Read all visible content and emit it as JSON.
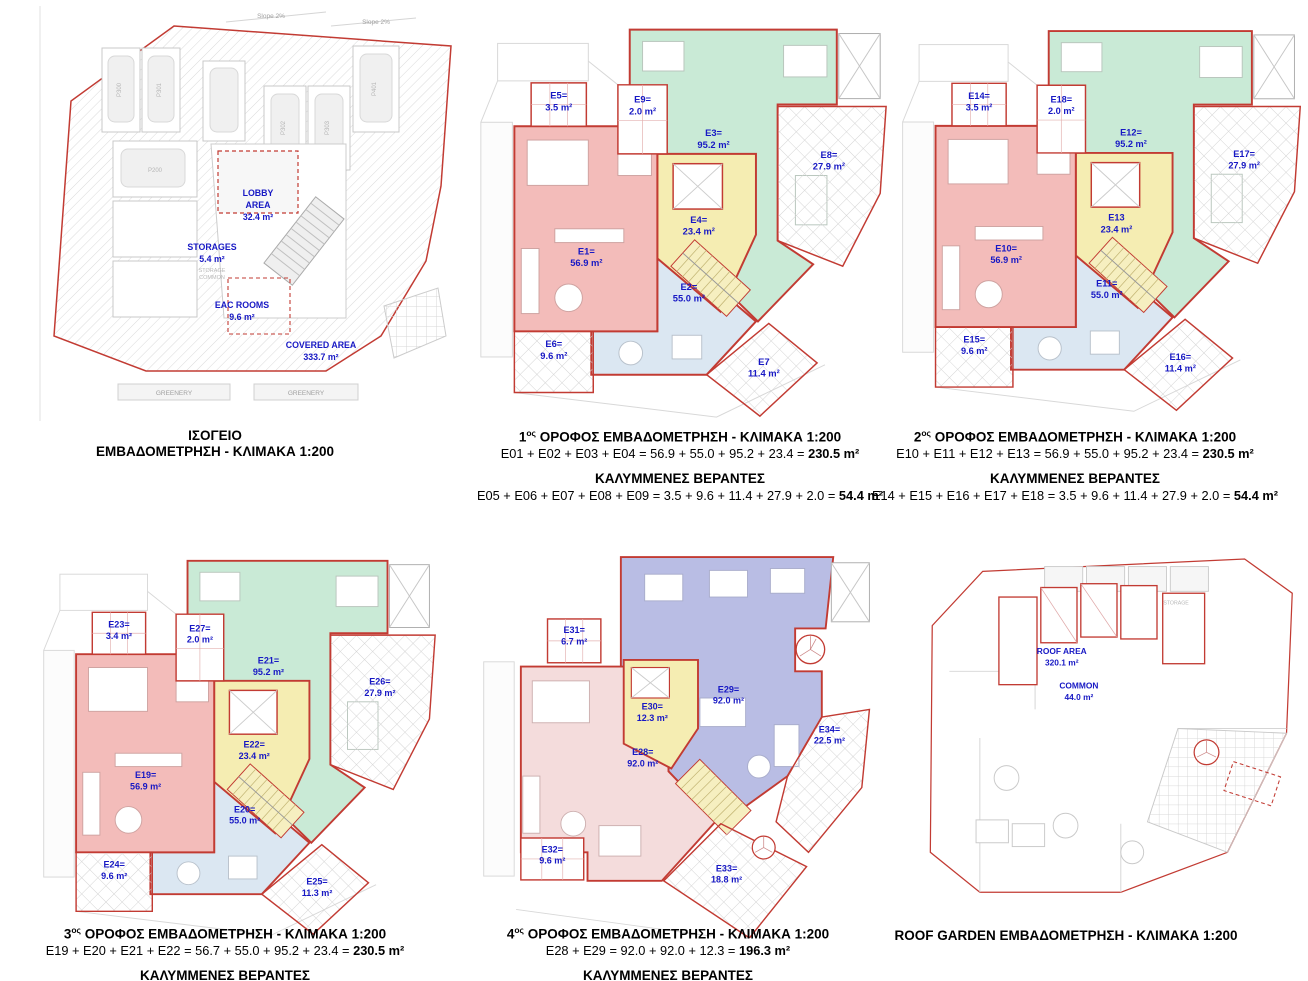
{
  "g": {
    "cap1": "ΙΣΟΓΕΙΟ",
    "cap2": "ΕΜΒΑΔΟΜΕΤΡΗΣΗ - ΚΛΙΜΑΚΑ 1:200",
    "slope_a": "Slope 2%",
    "slope_b": "Slope 2%",
    "greenery_a": "GREENERY",
    "greenery_b": "GREENERY",
    "storage_common_1": "STORAGE",
    "storage_common_2": "COMMON",
    "parking": {
      "a": "P300",
      "b": "P301",
      "c": "P302",
      "d": "P303",
      "e": "P401",
      "f": "P200"
    },
    "areas": {
      "lobby1": "LOBBY",
      "lobby2": "AREA",
      "lobby3": "32.4 m²",
      "stor1": "STORAGES",
      "stor2": "5.4 m²",
      "eac1": "EAC ROOMS",
      "eac2": "9.6 m²",
      "cov1": "COVERED AREA",
      "cov2": "333.7 m²"
    }
  },
  "f1": {
    "num": "1",
    "sup": "ος",
    "rest": " ΟΡΟΦΟΣ ΕΜΒΑΔΟΜΕΤΡΗΣΗ - ΚΛΙΜΑΚΑ 1:200",
    "sum_pre": "E01 + E02 + E03 + E04 = 56.9 + 55.0 + 95.2 + 23.4 =",
    "sum_total": "230.5 m²",
    "ver_title": "ΚΑΛΥΜΜΕΝΕΣ ΒΕΡΑΝΤΕΣ",
    "ver_pre": "E05 + E06 + E07 + E08 + E09 = 3.5 + 9.6 + 11.4 + 27.9 + 2.0 =",
    "ver_total": "54.4 m²",
    "units": {
      "e1": {
        "id": "E1=",
        "area": "56.9 m²"
      },
      "e2": {
        "id": "E2=",
        "area": "55.0 m²"
      },
      "e3": {
        "id": "E3=",
        "area": "95.2 m²"
      },
      "e4": {
        "id": "E4=",
        "area": "23.4 m²"
      },
      "e5": {
        "id": "E5=",
        "area": "3.5 m²"
      },
      "e6": {
        "id": "E6=",
        "area": "9.6 m²"
      },
      "e7": {
        "id": "E7",
        "area": "11.4 m²"
      },
      "e8": {
        "id": "E8=",
        "area": "27.9 m²"
      },
      "e9": {
        "id": "E9=",
        "area": "2.0 m²"
      }
    }
  },
  "f2": {
    "num": "2",
    "sup": "ος",
    "rest": " ΟΡΟΦΟΣ ΕΜΒΑΔΟΜΕΤΡΗΣΗ - ΚΛΙΜΑΚΑ 1:200",
    "sum_pre": "E10 + E11 + E12 + E13 = 56.9 + 55.0 + 95.2 + 23.4 =",
    "sum_total": "230.5 m²",
    "ver_title": "ΚΑΛΥΜΜΕΝΕΣ ΒΕΡΑΝΤΕΣ",
    "ver_pre": "E14 + E15 + E16 + E17 + E18 = 3.5 + 9.6 + 11.4 + 27.9 + 2.0 =",
    "ver_total": "54.4 m²",
    "units": {
      "e10": {
        "id": "E10=",
        "area": "56.9 m²"
      },
      "e11": {
        "id": "E11=",
        "area": "55.0 m²"
      },
      "e12": {
        "id": "E12=",
        "area": "95.2 m²"
      },
      "e13": {
        "id": "E13",
        "area": "23.4 m²"
      },
      "e14": {
        "id": "E14=",
        "area": "3.5 m²"
      },
      "e15": {
        "id": "E15=",
        "area": "9.6 m²"
      },
      "e16": {
        "id": "E16=",
        "area": "11.4 m²"
      },
      "e17": {
        "id": "E17=",
        "area": "27.9 m²"
      },
      "e18": {
        "id": "E18=",
        "area": "2.0 m²"
      }
    }
  },
  "f3": {
    "num": "3",
    "sup": "ος",
    "rest": " ΟΡΟΦΟΣ ΕΜΒΑΔΟΜΕΤΡΗΣΗ - ΚΛΙΜΑΚΑ 1:200",
    "sum_pre": "E19 + E20 + E21 + E22 = 56.7 + 55.0 + 95.2 + 23.4 =",
    "sum_total": "230.5 m²",
    "ver_title": "ΚΑΛΥΜΜΕΝΕΣ ΒΕΡΑΝΤΕΣ",
    "units": {
      "e19": {
        "id": "E19=",
        "area": "56.9 m²"
      },
      "e20": {
        "id": "E20=",
        "area": "55.0 m²"
      },
      "e21": {
        "id": "E21=",
        "area": "95.2 m²"
      },
      "e22": {
        "id": "E22=",
        "area": "23.4 m²"
      },
      "e23": {
        "id": "E23=",
        "area": "3.4 m²"
      },
      "e24": {
        "id": "E24=",
        "area": "9.6 m²"
      },
      "e25": {
        "id": "E25=",
        "area": "11.3 m²"
      },
      "e26": {
        "id": "E26=",
        "area": "27.9 m²"
      },
      "e27": {
        "id": "E27=",
        "area": "2.0 m²"
      }
    }
  },
  "f4": {
    "num": "4",
    "sup": "ος",
    "rest": " ΟΡΟΦΟΣ ΕΜΒΑΔΟΜΕΤΡΗΣΗ - ΚΛΙΜΑΚΑ 1:200",
    "sum_pre": "E28 + E29 = 92.0 + 92.0 + 12.3 =",
    "sum_total": "196.3 m²",
    "ver_title": "ΚΑΛΥΜΜΕΝΕΣ ΒΕΡΑΝΤΕΣ",
    "units": {
      "e28": {
        "id": "E28=",
        "area": "92.0 m²"
      },
      "e29": {
        "id": "E29=",
        "area": "92.0 m²"
      },
      "e30": {
        "id": "E30=",
        "area": "12.3 m²"
      },
      "e31": {
        "id": "E31=",
        "area": "6.7 m²"
      },
      "e32": {
        "id": "E32=",
        "area": "9.6 m²"
      },
      "e33": {
        "id": "E33=",
        "area": "18.8 m²"
      },
      "e34": {
        "id": "E34=",
        "area": "22.5 m²"
      }
    }
  },
  "r": {
    "cap": "ROOF GARDEN ΕΜΒΑΔΟΜΕΤΡΗΣΗ - ΚΛΙΜΑΚΑ 1:200",
    "roof1": "ROOF AREA",
    "roof2": "320.1 m²",
    "common1": "COMMON",
    "common2": "44.0 m²",
    "storage": "STORAGE"
  },
  "colors": {
    "unit_red": "#f3bcba",
    "unit_green": "#c9ead6",
    "unit_blue": "#dbe7f2",
    "core_yellow": "#f5edb2",
    "unit_purple": "#b9bde4",
    "unit_pink": "#f4dcdc",
    "outline_red": "#c23b33",
    "label_blue": "#1718c4"
  }
}
